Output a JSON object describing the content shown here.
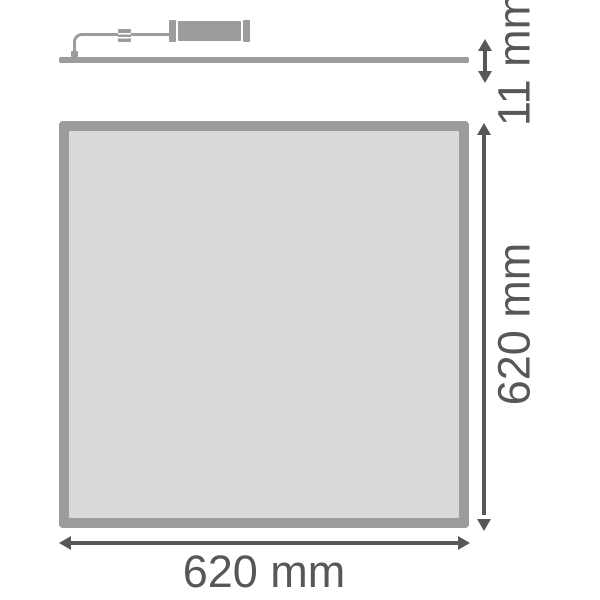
{
  "drawing": {
    "description": "LED panel luminaire dimension drawing"
  },
  "dimensions": {
    "thickness": {
      "label": "11 mm"
    },
    "height": {
      "label": "620 mm"
    },
    "width": {
      "label": "620 mm"
    }
  },
  "colors": {
    "background": "#ffffff",
    "hardware": "#9c9c9c",
    "panel_fill": "#d9d9d9",
    "dimension": "#57575a"
  },
  "icons": {
    "thickness_arrow": "double-headed-vertical-arrow",
    "height_arrow": "double-headed-vertical-arrow",
    "width_arrow": "double-headed-horizontal-arrow"
  }
}
